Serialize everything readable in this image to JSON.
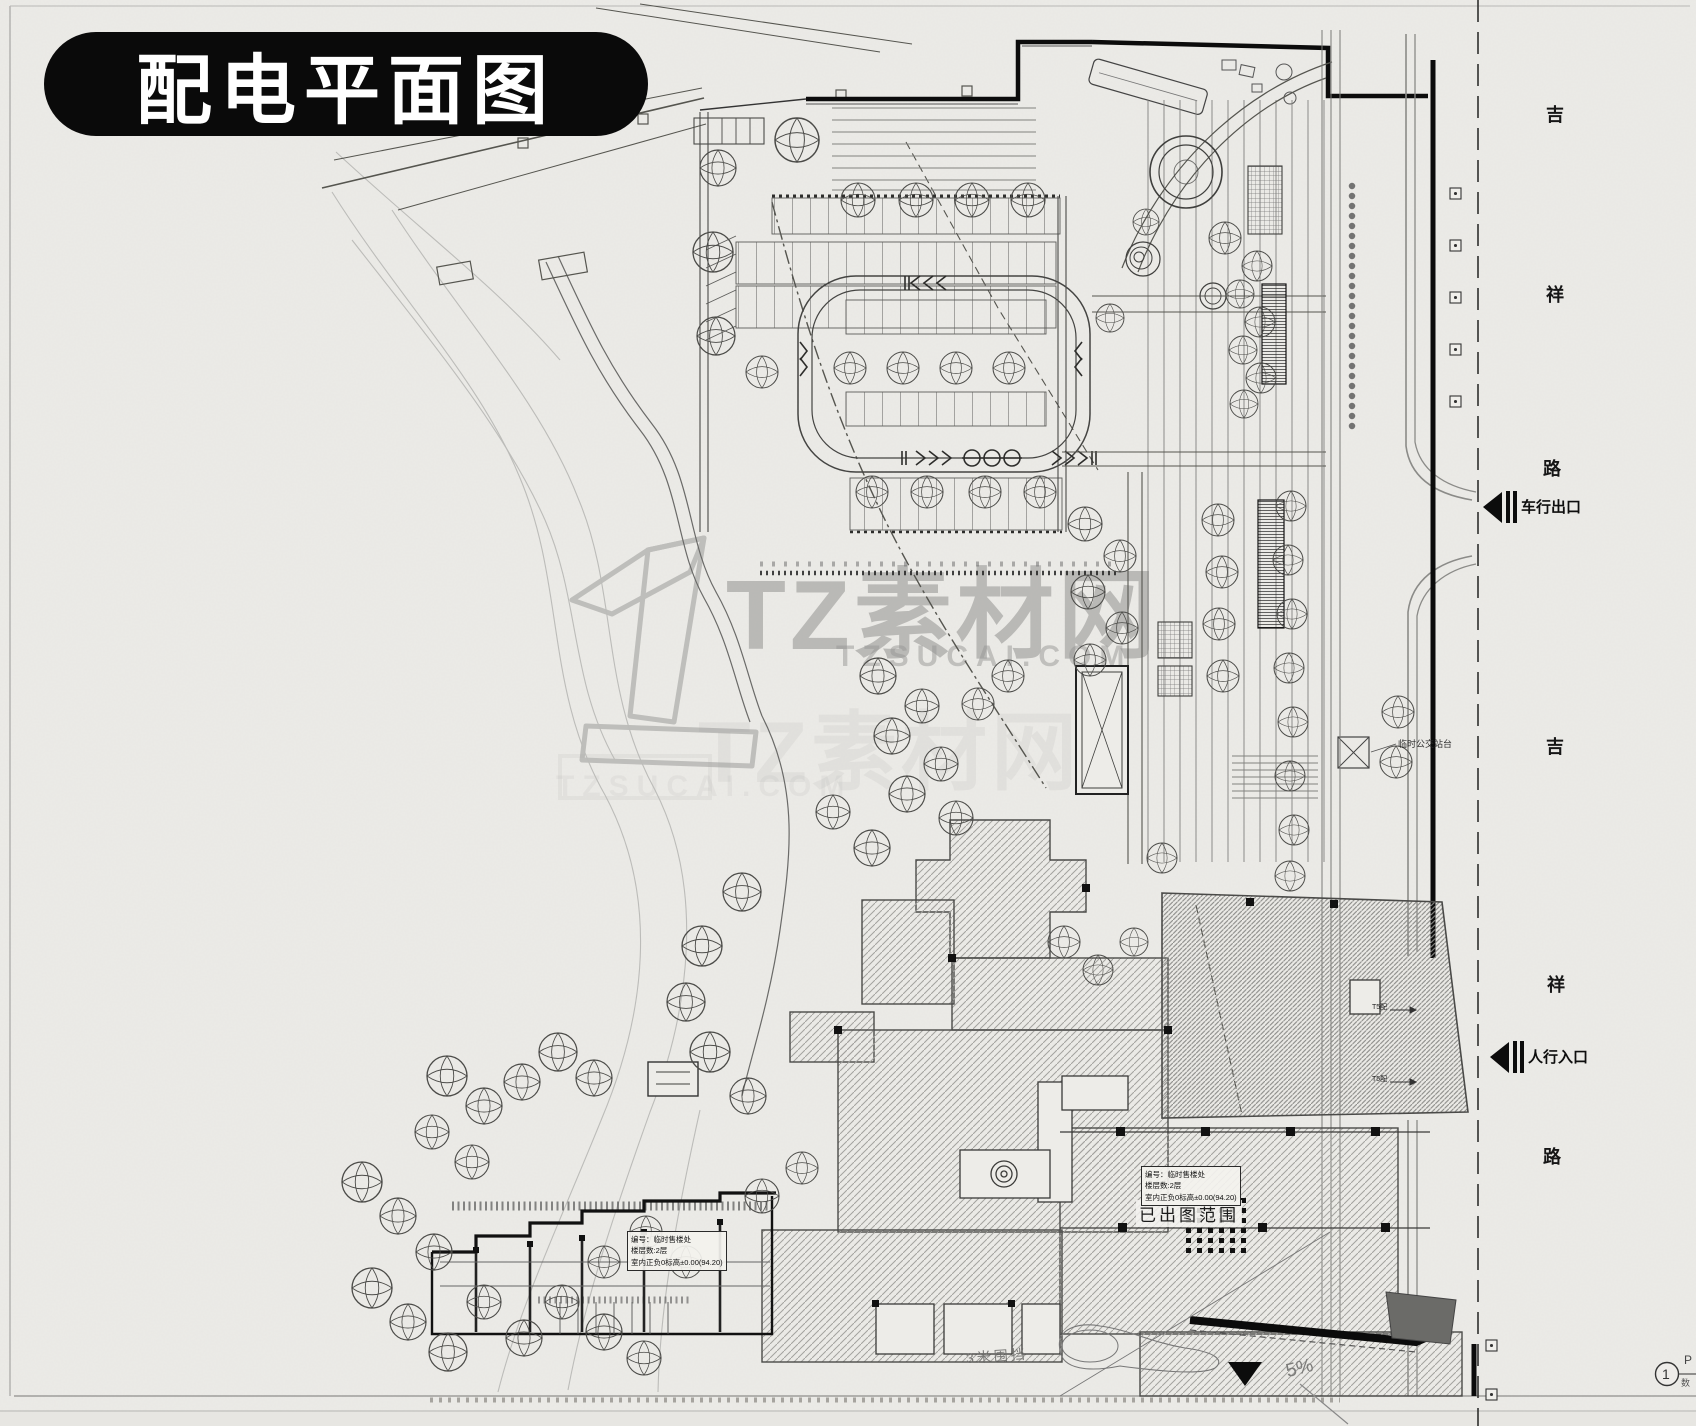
{
  "title": "配电平面图",
  "watermark": {
    "brand": "TZ素材网",
    "domain": "TZSUCAI.COM",
    "brand_faint": "TZ素材网",
    "domain_faint": "TZSUCAI.COM"
  },
  "roads": {
    "jixiang_top": [
      "吉",
      "祥",
      "路"
    ],
    "jixiang_bottom": [
      "吉",
      "祥",
      "路"
    ]
  },
  "labels": {
    "vehicle_exit": "车行出口",
    "pedestrian_entry": "人行入口",
    "issued_scope": "已出图范围",
    "hoarding_3m": "3米围挡",
    "slope": "5%",
    "bus_platform": "临时公交站台",
    "t5_feeder_a": "T5配",
    "t5_feeder_b": "T5配",
    "detail_bubble_no": "1",
    "detail_bubble_top": "P",
    "detail_bubble_bottom": "数"
  },
  "building_notes": {
    "sales_office_left": {
      "line1": "编号：临时售楼处",
      "line2": "楼层数:2层",
      "line3": "室内正负0标高±0.00(94.20)"
    },
    "sales_office_right": {
      "line1": "编号：临时售楼处",
      "line2": "楼层数:2层",
      "line3": "室内正负0标高±0.00(94.20)"
    }
  },
  "colors": {
    "paper": "#ecebe7",
    "ink": "#2f2f2f",
    "title_pill": "#0a0a0a",
    "watermark": "#8e8e8c"
  }
}
